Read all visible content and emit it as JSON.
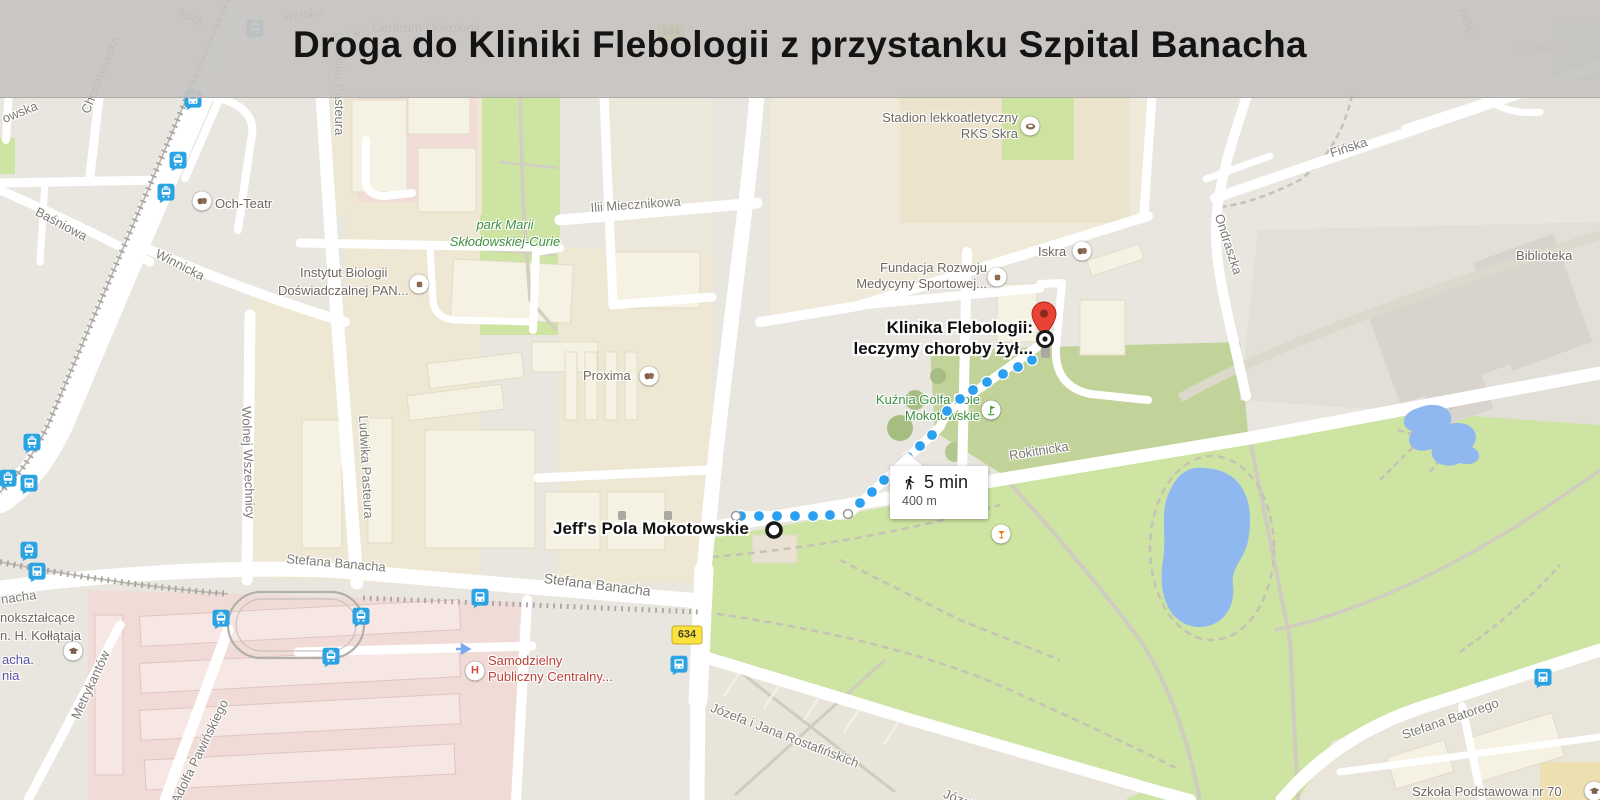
{
  "banner": {
    "title": "Droga do Kliniki Flebologii z przystanku Szpital Banacha"
  },
  "roads": {
    "shield": "634"
  },
  "route": {
    "start_label": "Jeff's Pola Mokotowskie",
    "dest_line1": "Klinika Flebologii:",
    "dest_line2": "leczymy choroby żył...",
    "duration": "5 min",
    "distance": "400 m",
    "color": "#2b9ff0",
    "pin_color": "#ea4335",
    "dots_blue": [
      [
        741,
        516
      ],
      [
        759,
        516
      ],
      [
        777,
        516
      ],
      [
        795,
        516
      ],
      [
        813,
        516
      ],
      [
        830,
        515
      ],
      [
        860,
        503
      ],
      [
        872,
        492
      ],
      [
        884,
        480
      ],
      [
        896,
        469
      ],
      [
        908,
        457
      ],
      [
        920,
        446
      ],
      [
        932,
        435
      ],
      [
        947,
        411
      ],
      [
        960,
        399
      ],
      [
        973,
        390
      ],
      [
        987,
        382
      ],
      [
        1003,
        374
      ],
      [
        1018,
        367
      ],
      [
        1032,
        360
      ]
    ],
    "dots_white": [
      [
        736,
        516
      ],
      [
        848,
        514
      ]
    ],
    "start": [
      774,
      530
    ],
    "target": [
      1045,
      339
    ]
  },
  "streets": [
    "Stefana Banacha",
    "Stefana Banacha",
    "nacha",
    "Ilii Miecznikowa",
    "Winnicka",
    "Baśniowa",
    "Chotomowska",
    "owska",
    "Ludwika Pasteura",
    "Ludwika Pasteura",
    "Wolnej Wszechnicy",
    "Metrykantów",
    "Adolfa Pawińskiego",
    "Stefana Batorego",
    "Józefa i Jana Rostafińskich",
    "Józef",
    "Rokitnicka",
    "Ondraszka",
    "Fińska",
    "batki",
    "ńska",
    "wełska"
  ],
  "places": {
    "och": "Och-Teatr",
    "instytut1": "Instytut Biologii",
    "instytut2": "Doświadczalnej PAN...",
    "proxima": "Proxima",
    "park1": "park Marii",
    "park2": "Skłodowskiej-Curie",
    "stadion1": "Stadion lekkoatletyczny",
    "stadion2": "RKS Skra",
    "fundacja1": "Fundacja Rozwoju",
    "fundacja2": "Medycyny Sportowej...",
    "iskra": "Iskra",
    "kuznia1": "Kuźnia Golfa Pole",
    "kuznia2": "Mokotowskie",
    "szpital1": "Samodzielny",
    "szpital2": "Publiczny Centralny...",
    "szkola": "Szkoła Podstawowa nr 70",
    "liceum1": "nokształcące",
    "liceum2": "n. H. Kołłątaja",
    "biblioteka": "Biblioteka",
    "klinika": "Klinika",
    "onkologia": "Centrum Onkologii",
    "stop1": "acha.",
    "stop2": "nia"
  }
}
